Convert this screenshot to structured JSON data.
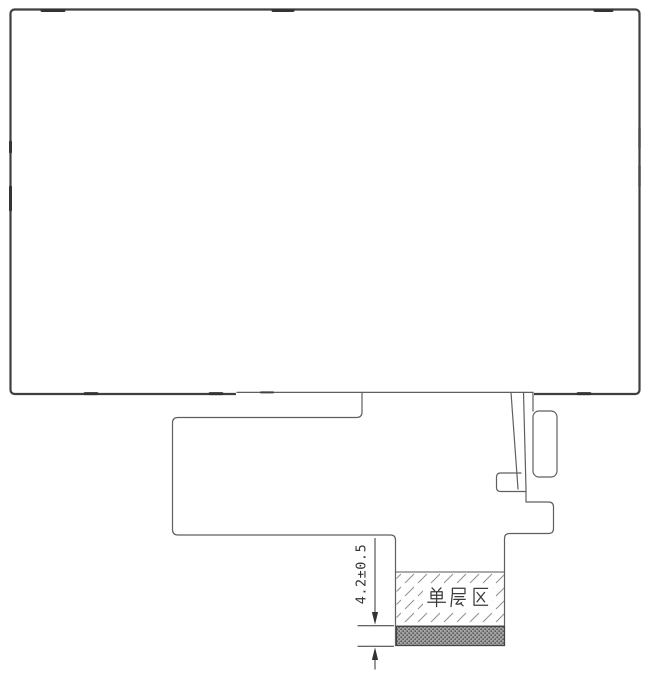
{
  "drawing": {
    "dimension_label": "4.2±0.5",
    "single_layer_label": "单层区",
    "colors": {
      "panel_outline": "#3f3f3f",
      "fpc_outline": "#5f5f5f",
      "dimension_line": "#333333",
      "hatch_line": "#8f8f8f",
      "strip_fill": "#a3a3a3",
      "strip_dot": "#5c5c5c",
      "background": "#ffffff"
    }
  }
}
